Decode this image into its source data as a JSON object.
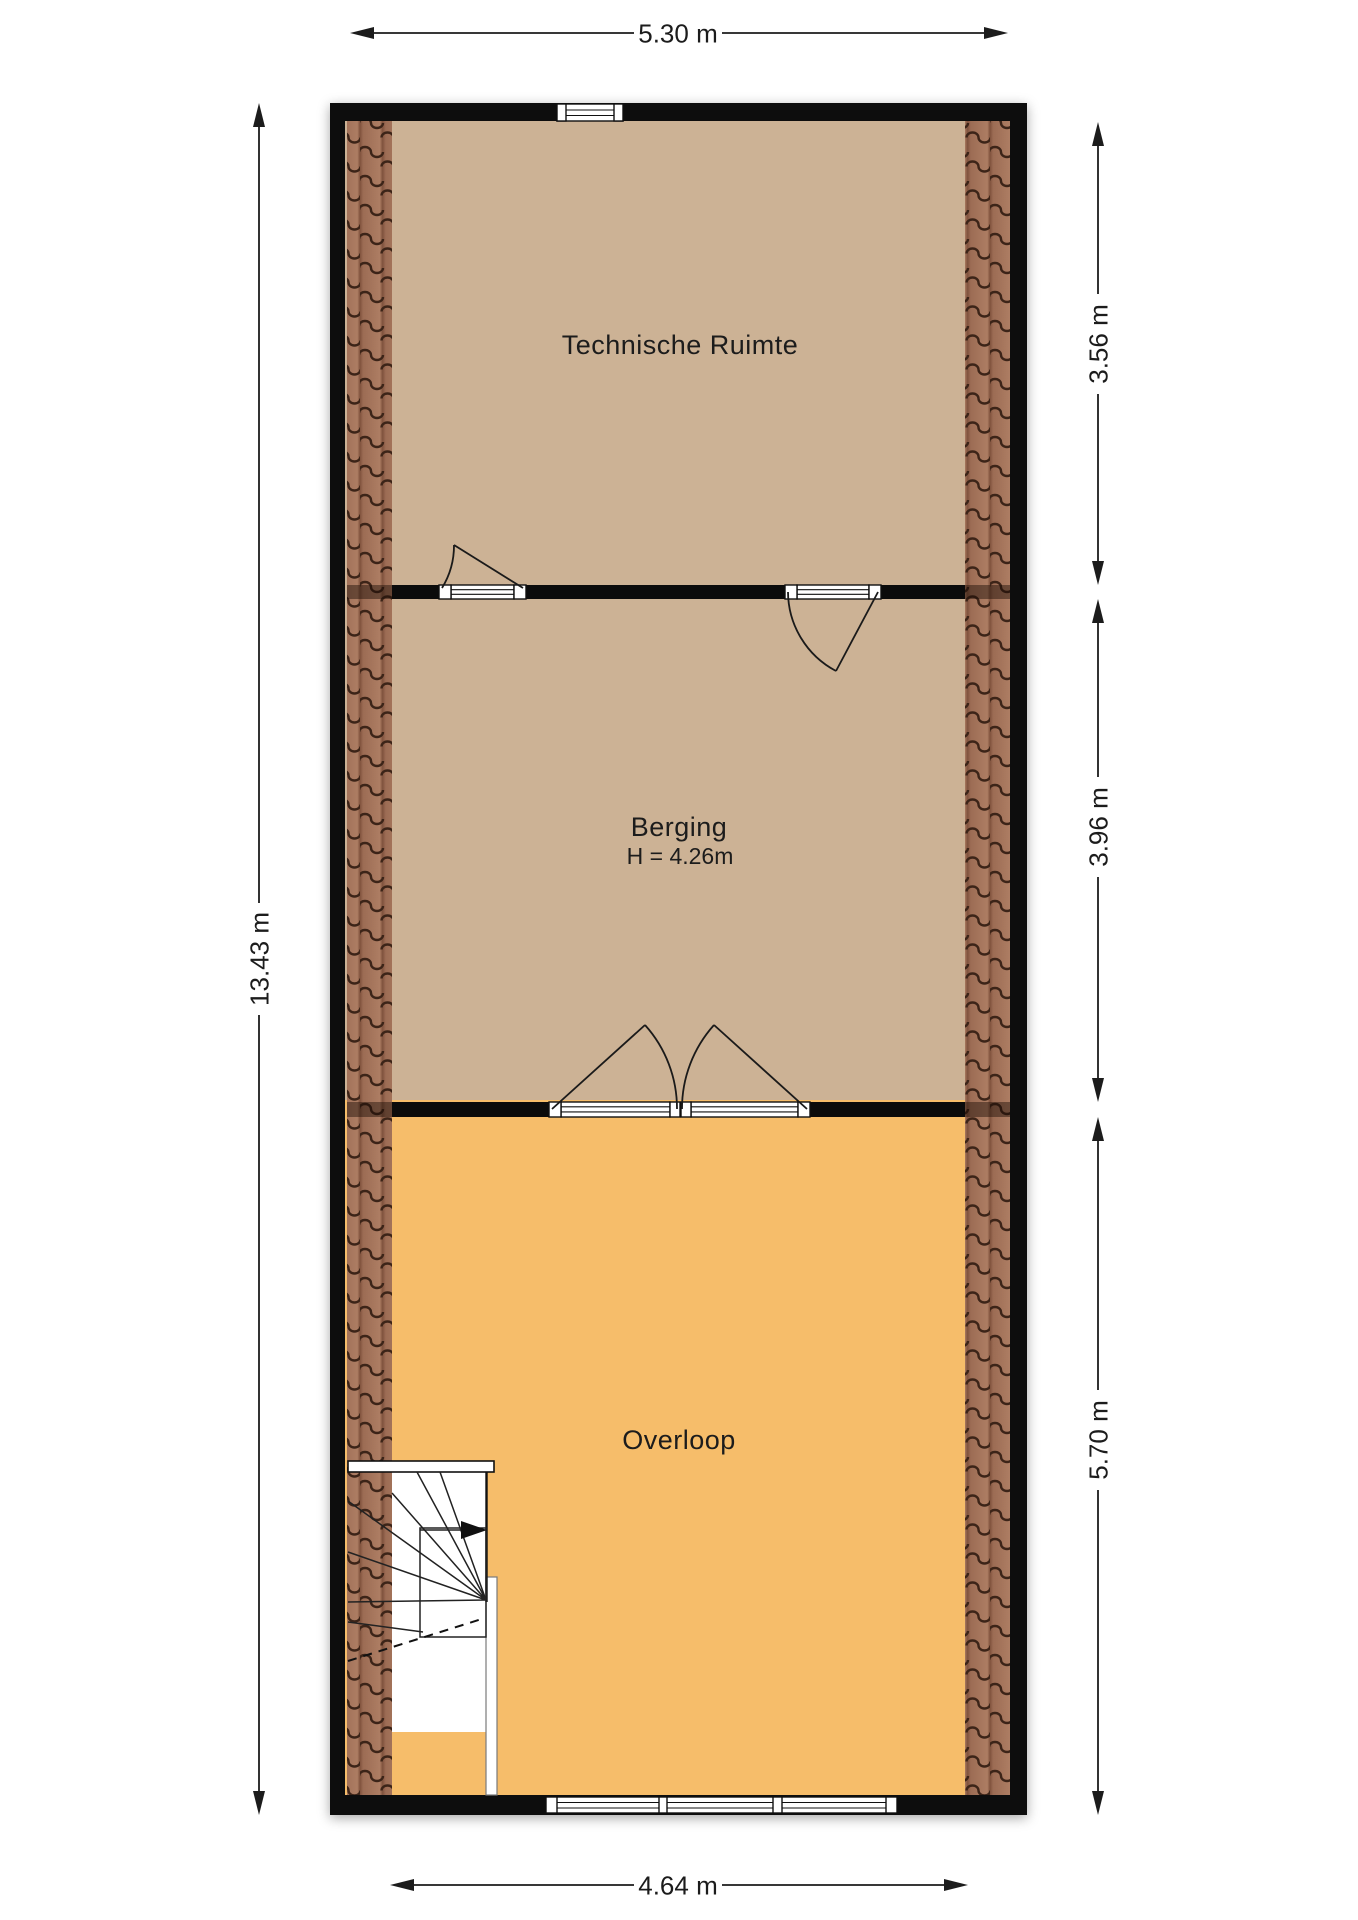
{
  "plan": {
    "rooms": [
      {
        "name": "Technische Ruimte"
      },
      {
        "name": "Berging",
        "height_note": "H = 4.26m"
      },
      {
        "name": "Overloop"
      }
    ],
    "dimensions": {
      "top_width": "5.30 m",
      "left_height": "13.43 m",
      "right_top": "3.56 m",
      "right_middle": "3.96 m",
      "right_bottom": "5.70 m",
      "bottom_width": "4.64 m"
    },
    "colors": {
      "bg": "#ffffff",
      "wall": "#0b0b0b",
      "room_tan": "#ccb295",
      "room_orange": "#f6bd6a",
      "tile_base": "#9c6c54",
      "tile_light": "#ad7d63",
      "tile_edge": "#7f523d",
      "tile_dark": "#3c2418",
      "dim": "#1c1c1c"
    }
  }
}
